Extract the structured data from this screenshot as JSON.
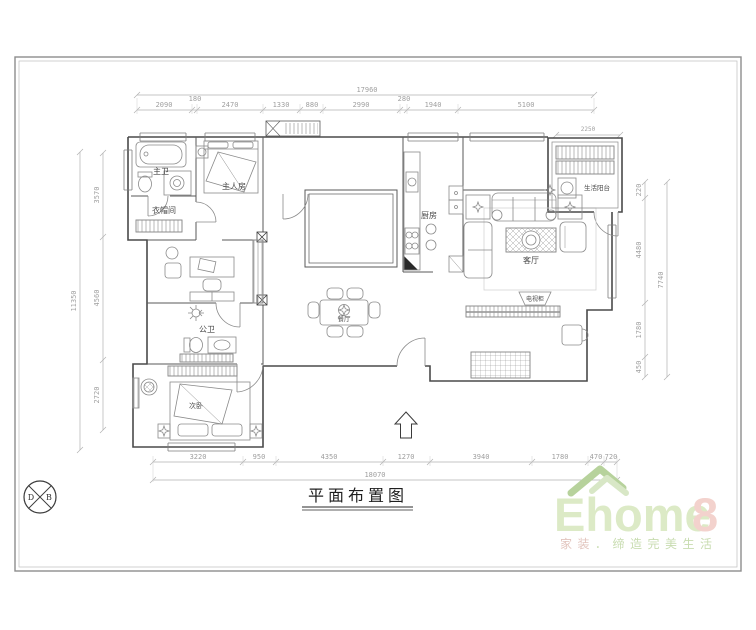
{
  "title": {
    "text": "平面布置图"
  },
  "rooms": {
    "master_bath": "主卫",
    "cloakroom": "衣帽间",
    "master_bedroom": "主人房",
    "public_bath": "公卫",
    "second_bedroom": "次卧",
    "dining": "餐厅",
    "kitchen": "厨房",
    "living": "客厅",
    "balcony": "生活阳台",
    "tv_cabinet": "电视柜"
  },
  "dims": {
    "top_total": "17960",
    "top": [
      "2090",
      "180",
      "2470",
      "1330",
      "880",
      "2990",
      "280",
      "1940",
      "5100"
    ],
    "bottom": [
      "3220",
      "950",
      "4350",
      "1270",
      "3940",
      "1780",
      "470",
      "720"
    ],
    "bottom_total": "18070",
    "left": [
      "3570",
      "4560",
      "2720"
    ],
    "left_total": "11350",
    "right": [
      "220",
      "4480",
      "1780",
      "450"
    ],
    "right_total": "7740",
    "balcony_width": "2250"
  },
  "logo": {
    "brand": "Ehome",
    "brand_suffix": "8",
    "tagline_left": "家装",
    "tagline_right": "．缔造完美生活"
  },
  "stamp": {
    "left": "D",
    "right": "B"
  },
  "colors": {
    "wall": "#4a4a4a",
    "furniture": "#8a8a8a",
    "dimension": "#b0b0b0",
    "logo_green": "#dceac6",
    "logo_pink": "#f3d2cd",
    "roof_green": "#b7d29c"
  }
}
